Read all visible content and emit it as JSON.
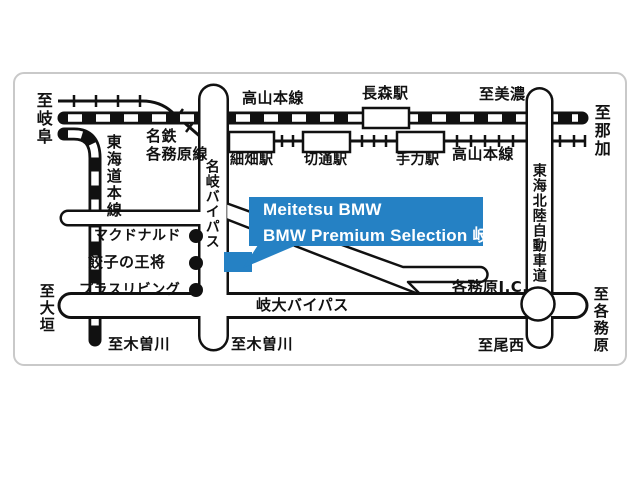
{
  "map": {
    "callout": {
      "line1": "Meitetsu BMW",
      "line2": "BMW Premium Selection 岐阜"
    },
    "colors": {
      "accent_blue": "#2581c4",
      "line_black": "#111111",
      "frame_gray": "#c9c9c9"
    },
    "railways": {
      "takayama_main_line_top": "高山本線",
      "takayama_main_line_right": "高山本線",
      "meitetsu_name": "名鉄",
      "meitetsu_kakamigahara_line": "各務原線",
      "tokaido_main_line": "東海道本線"
    },
    "stations": {
      "nagamori": "長森駅",
      "hosobata": "細畑駅",
      "kiridoshi": "切通駅",
      "tejikara": "手力駅"
    },
    "roads": {
      "meigi_bypass": "名岐バイパス",
      "gidai_bypass": "岐大バイパス",
      "tokai_hokuriku_expressway": "東海北陸自動車道",
      "kakamigahara_ic": "各務原I.C."
    },
    "directions": {
      "to_gifu": "至岐阜",
      "to_mino": "至美濃",
      "to_naka": "至那加",
      "to_ogaki": "至大垣",
      "to_kisogawa_left": "至木曽川",
      "to_kisogawa_center": "至木曽川",
      "to_bisai": "至尾西",
      "to_kakamigahara": "至各務原"
    },
    "pois": {
      "mcdonalds": "マクドナルド",
      "gyoza_no_ohsho": "餃子の王将",
      "plus_living": "プラスリビング"
    }
  }
}
